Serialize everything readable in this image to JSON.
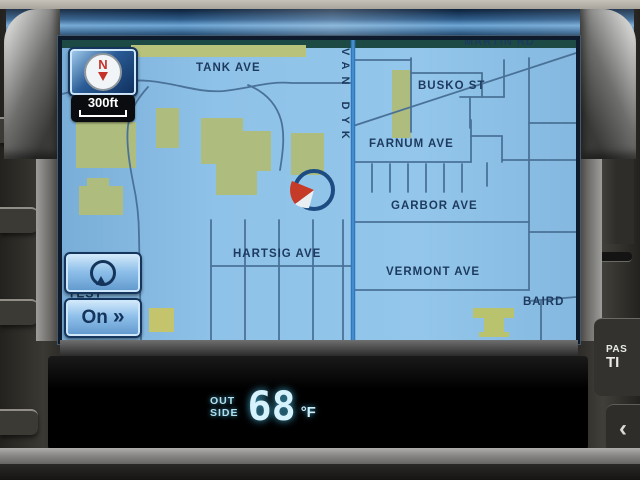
{
  "map": {
    "compass": "N",
    "scale": "300ft",
    "streets": {
      "tank": "TANK AVE",
      "van_dyke": "VAN DYK",
      "martin": "MARTIN RD",
      "busko": "BUSKO ST",
      "farnum": "FARNUM AVE",
      "garbor": "GARBOR AVE",
      "hartsig": "HARTSIG AVE",
      "vermont": "VERMONT AVE",
      "baird": "BAIRD",
      "test_partial": "TEST"
    },
    "controls": {
      "on_label": "On",
      "on_arrows": "»"
    }
  },
  "climate": {
    "outside_label_top": "OUT",
    "outside_label_bottom": "SIDE",
    "temperature": "68",
    "unit": "°F"
  },
  "bezel": {
    "pass_button_line1": "PAS",
    "pass_button_line2": "TI",
    "chevron": "‹"
  },
  "colors": {
    "map_background": "#8fc0e5",
    "land_parcel": "#aebd7d",
    "minor_road": "#4a7298",
    "major_road": "#2e78bc",
    "street_label": "#1d3a5e",
    "button_face": "#8fc0ea",
    "temp_display": "#cfeefb"
  }
}
